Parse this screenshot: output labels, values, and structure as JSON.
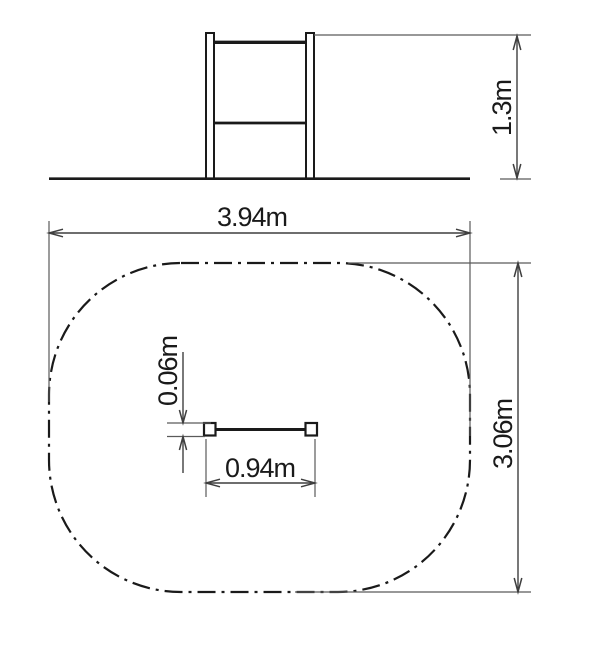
{
  "drawing": {
    "type": "dimensioned technical drawing: side elevation and plan view with safety-zone outline",
    "colors": {
      "background": "#ffffff",
      "object_line": "#1a1a1a",
      "dimension_line": "#3f3f3f",
      "extension_line": "#5a5a5a"
    },
    "elevation": {
      "height_label": "1.3m"
    },
    "plan": {
      "zone_width_label": "3.94m",
      "zone_depth_label": "3.06m",
      "bar_length_label": "0.94m",
      "bar_thickness_label": "0.06m"
    }
  }
}
